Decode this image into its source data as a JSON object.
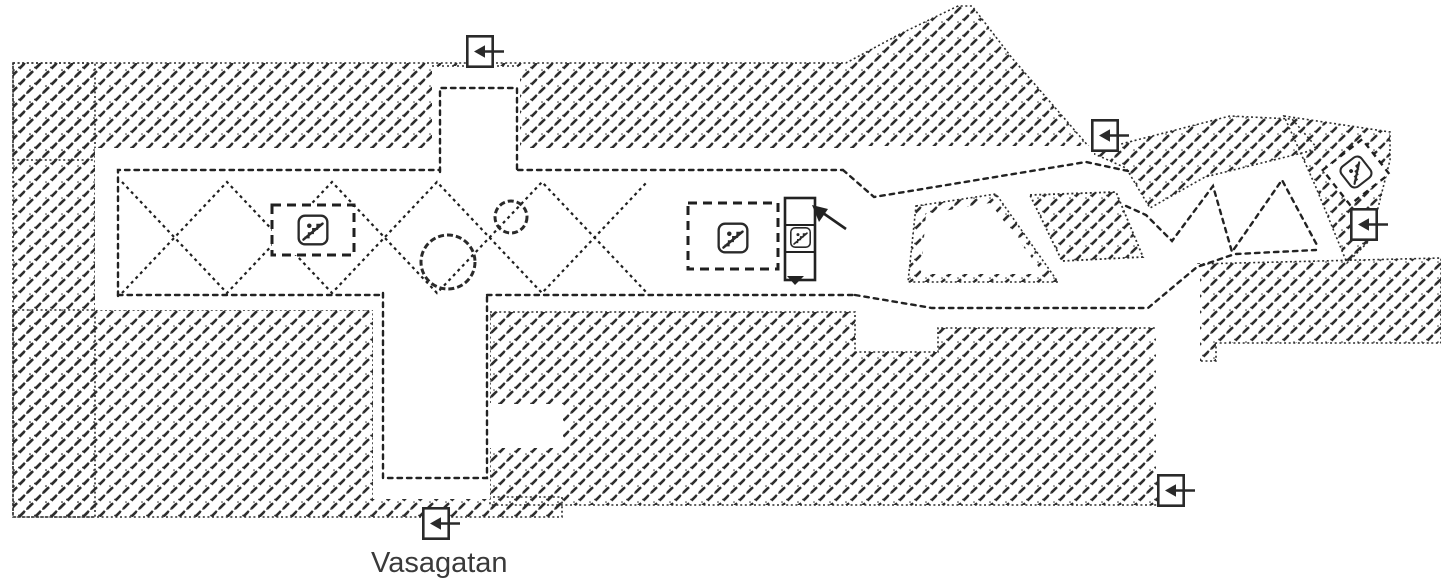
{
  "page": {
    "background": "#ffffff"
  },
  "map": {
    "kind": "metro-station-floor-plan",
    "street_label": "Vasagatan",
    "ink_color": "#2b2b2b",
    "label_color": "#3a3a3a",
    "exits": [
      {
        "id": "exit-top",
        "icon": "exit-door-left-arrow"
      },
      {
        "id": "exit-upper-right",
        "icon": "exit-door-left-arrow"
      },
      {
        "id": "exit-far-right",
        "icon": "exit-door-left-arrow"
      },
      {
        "id": "exit-lower-right",
        "icon": "exit-door-left-arrow"
      },
      {
        "id": "exit-vasagatan",
        "icon": "exit-door-left-arrow"
      }
    ],
    "escalators": [
      {
        "id": "escalator-platform-west",
        "icon": "escalator"
      },
      {
        "id": "escalator-platform-east",
        "icon": "escalator"
      },
      {
        "id": "escalator-lift-bank",
        "icon": "escalator"
      },
      {
        "id": "escalator-northeast-exit",
        "icon": "escalator"
      }
    ]
  }
}
